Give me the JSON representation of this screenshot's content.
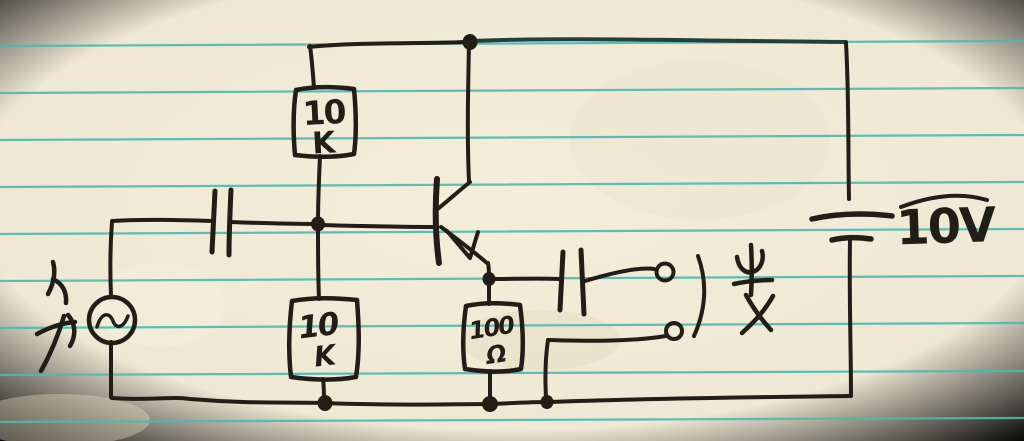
{
  "document": {
    "kind": "Hand-drawn circuit schematic on ruled notebook paper",
    "circuit_summary": "AC source with input coupling capacitor feeding a 10K/10K divider-biased NPN transistor, 100 ohm emitter resistor, output coupling capacitor to two output terminals, powered by a 10V battery"
  },
  "labels": {
    "r1_value": "10",
    "r1_unit": "K",
    "r2_value": "10",
    "r2_unit": "K",
    "re_value": "100",
    "re_unit": "Ω",
    "battery_label": "10V"
  },
  "components": [
    {
      "name": "ac-source",
      "symbol": "circle with sine wave"
    },
    {
      "name": "input-coupling-capacitor",
      "symbol": "two parallel plates"
    },
    {
      "name": "resistor-r1",
      "value": "10K"
    },
    {
      "name": "resistor-r2",
      "value": "10K"
    },
    {
      "name": "transistor",
      "symbol": "NPN with arrow on emitter"
    },
    {
      "name": "emitter-resistor",
      "value": "100Ω"
    },
    {
      "name": "output-coupling-capacitor",
      "symbol": "two parallel plates"
    },
    {
      "name": "output-terminals",
      "symbol": "two open circles with bracket"
    },
    {
      "name": "battery",
      "value": "10V"
    }
  ],
  "colors": {
    "paper": "#f0e9d6",
    "rule_line": "#4fb9af",
    "ink": "#221d17"
  }
}
